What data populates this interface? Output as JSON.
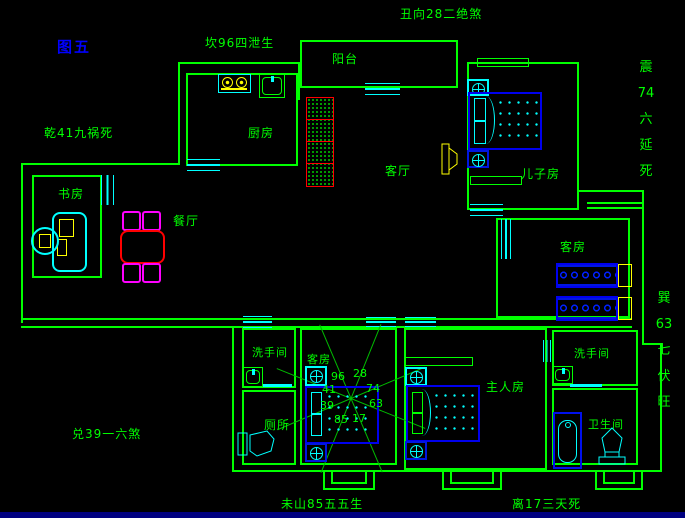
{
  "title": {
    "figure": "图五"
  },
  "annotations": {
    "top": "丑向28二绝煞",
    "upper_left": "坎96四泄生",
    "left": "乾41九祸死",
    "lower_left": "兑39一六煞",
    "bottom_left": "未山85五五生",
    "bottom_right": "离17三天死",
    "right_upper": [
      "震",
      "74",
      "六",
      "延",
      "死"
    ],
    "right_lower": [
      "巽",
      "63",
      "七",
      "伏",
      "旺"
    ]
  },
  "rooms": {
    "balcony": {
      "label": "阳台"
    },
    "kitchen": {
      "label": "厨房"
    },
    "living_room": {
      "label": "客厅"
    },
    "son_room": {
      "label": "儿子房"
    },
    "study": {
      "label": "书房"
    },
    "dining": {
      "label": "餐厅"
    },
    "guest_room_east": {
      "label": "客房"
    },
    "guest_room_center": {
      "label": "客房"
    },
    "washroom_west": {
      "label": "洗手间"
    },
    "toilet_room": {
      "label": "厕所"
    },
    "master_room": {
      "label": "主人房"
    },
    "washroom_east": {
      "label": "洗手间"
    },
    "bathroom": {
      "label": "卫生间"
    }
  },
  "compass": {
    "numbers": {
      "top_left": "96",
      "top_right": "28",
      "upper_left": "41",
      "upper_right": "74",
      "lower_left": "39",
      "lower_right": "63",
      "bottom_left": "85",
      "bottom_right": "17"
    }
  },
  "colors": {
    "background": "#000000",
    "wall_green": "#00ff00",
    "fixture_cyan": "#00ffff",
    "bed_blue": "#0000ee",
    "accent_red": "#ff0000",
    "chair_magenta": "#ff00ff",
    "accent_yellow": "#ffff00",
    "figure_label_blue": "#0000ff",
    "bottom_bar_navy": "#000080"
  }
}
